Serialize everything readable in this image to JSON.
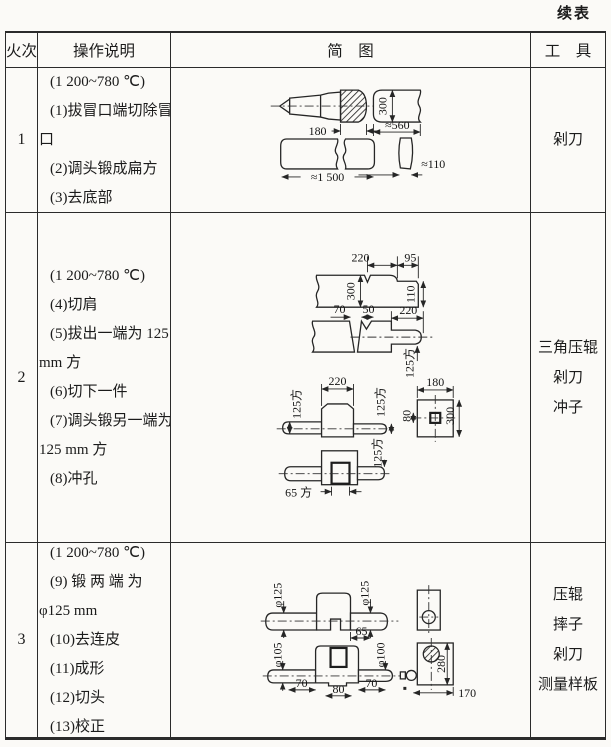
{
  "page": {
    "continued_label": "续表"
  },
  "colors": {
    "ink": "#1b1b1b",
    "paper": "#fbfaf7",
    "line": "#2b2b2b"
  },
  "header": {
    "heat": "火次",
    "operations": "操作说明",
    "sketch": "简　图",
    "tools": "工　具"
  },
  "rows": [
    {
      "heat": "1",
      "ops": [
        "(1 200~780 ℃)",
        "(1)拔冒口端切除冒",
        "口",
        "(2)调头锻成扁方",
        "(3)去底部"
      ],
      "tools": [
        "剁刀"
      ],
      "dims": {
        "riser": "180",
        "height": "300",
        "seg": "≈560",
        "total": "≈1 500",
        "slice": "≈110"
      }
    },
    {
      "heat": "2",
      "ops": [
        "(1 200~780 ℃)",
        "(4)切肩",
        "(5)拔出一端为 125",
        "mm 方",
        "(6)切下一件",
        "(7)调头锻另一端为",
        "125 mm 方",
        "(8)冲孔"
      ],
      "tools": [
        "三角压辊",
        "剁刀",
        "冲子"
      ],
      "dims": {
        "a220": "220",
        "a95": "95",
        "a300": "300",
        "a110": "110",
        "b70": "70",
        "b50": "50",
        "b220": "220",
        "b125": "125方",
        "c220": "220",
        "c125l": "125方",
        "c125r": "125方",
        "c180": "180",
        "c80": "80",
        "c300": "300",
        "d65": "65 方",
        "d125": "125方"
      }
    },
    {
      "heat": "3",
      "ops": [
        "(1 200~780 ℃)",
        "(9) 锻 两 端 为",
        "φ125 mm",
        "(10)去连皮",
        "(11)成形",
        "(12)切头",
        "(13)校正"
      ],
      "tools": [
        "压辊",
        "摔子",
        "剁刀",
        "测量样板"
      ],
      "dims": {
        "a125l": "φ125",
        "a125r": "φ125",
        "a65": "65",
        "b105": "φ105",
        "b100": "φ100",
        "b70a": "70",
        "b80": "80",
        "b70b": "70",
        "b280": "280",
        "b170": "170"
      }
    }
  ]
}
